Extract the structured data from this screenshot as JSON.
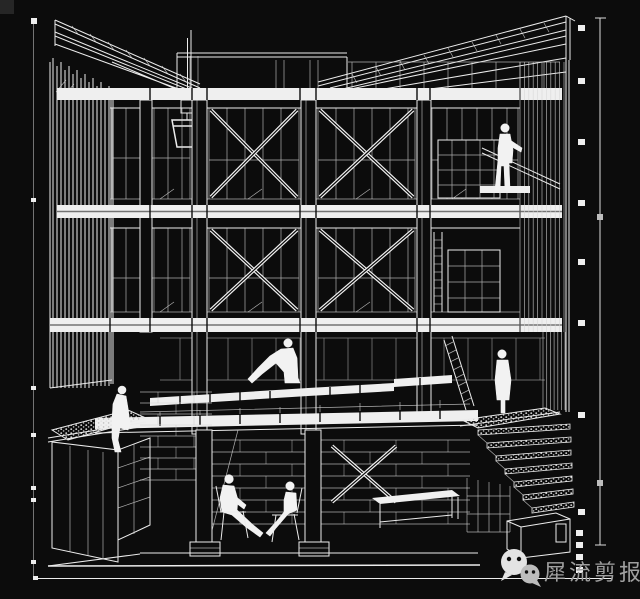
{
  "canvas": {
    "width": 640,
    "height": 599,
    "background_color": "#0c0c0c",
    "line_color": "#ececec",
    "dimension_mark_color": "#dcdcdc",
    "watermark_text_color": "#9f9f9f"
  },
  "watermark": {
    "icon": "wechat-bubbles-icon",
    "text": "犀流剪报"
  },
  "annotation_marks": {
    "left_dimension_ticks_y": [
      21,
      200,
      388,
      435,
      488,
      500,
      562,
      578
    ],
    "right_dimension_ticks_y": [
      28,
      81,
      142,
      203,
      262,
      323,
      415,
      512,
      533,
      545,
      557,
      570
    ]
  },
  "scene": {
    "type": "sectional perspective architectural wireframe, white lines on black",
    "levels": [
      "butterfly rafter roof with hanging pulley and bucket",
      "third floor: X-braced glazed bays, storage rack, standing figure at right",
      "second floor: X-braced glazed bays, ladder and shelving at right",
      "ground floor: open timber deck with sitting figure, green-roof planter at left, terrace and ladder at right",
      "basement: masonry walls, two seated figures with chairs and table, stepped seating descending to a small hut at right"
    ],
    "figures": [
      "standing-person-third-floor-right",
      "sitting-person-on-deck",
      "sitting-person-on-green-roof-edge",
      "seated-person-on-chair-left",
      "seated-person-on-chair-right",
      "standing-person-on-terrace"
    ]
  }
}
